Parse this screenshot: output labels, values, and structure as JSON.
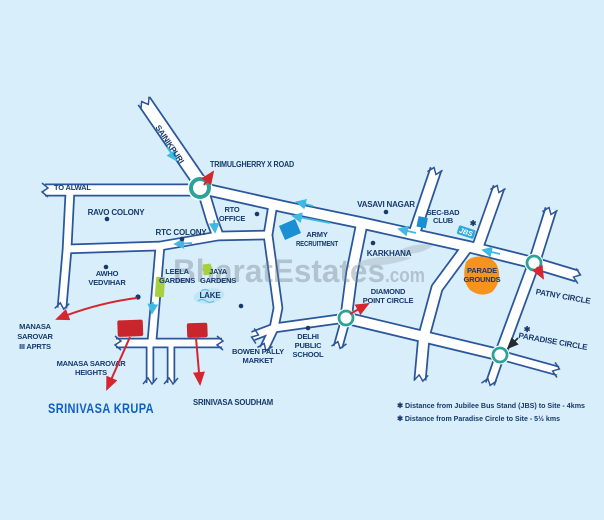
{
  "watermark": {
    "name": "BharatEstates",
    "tld": ".com"
  },
  "site": {
    "name": "SRINIVASA KRUPA",
    "sister": "SRINIVASA SOUDHAM"
  },
  "roads": {
    "sainikpuri": "SAINIKPURI",
    "to_alwal": "TO ALWAL",
    "trimulgherry": "TRIMULGHERRY X ROAD"
  },
  "places": {
    "ravo_colony": "RAVO COLONY",
    "rtc_colony": "RTC COLONY",
    "rto_office": [
      "RTO",
      "OFFICE"
    ],
    "army_recruitment": [
      "ARMY",
      "RECRUITMENT"
    ],
    "vasavi_nagar": "VASAVI NAGAR",
    "sec_bad_club": [
      "SEC-BAD",
      "CLUB"
    ],
    "jbs": "JBS",
    "karkhana": "KARKHANA",
    "parade_grounds": [
      "PARADE",
      "GROUNDS"
    ],
    "patny_circle": "PATNY CIRCLE",
    "paradise_circle": "PARADISE CIRCLE",
    "diamond_point_circle": [
      "DIAMOND",
      "POINT CIRCLE"
    ],
    "awho_vedvihar": [
      "AWHO",
      "VEDVIHAR"
    ],
    "leela_gardens": [
      "LEELA",
      "GARDENS"
    ],
    "jaya_gardens": [
      "JAYA",
      "GARDENS"
    ],
    "lake": "LAKE",
    "manasa_sarovar_apts": [
      "MANASA",
      "SAROVAR",
      "III APRTS"
    ],
    "manasa_sarovar_heights": [
      "MANASA SAROVAR",
      "HEIGHTS"
    ],
    "bowen_pally_market": [
      "BOWEN PALLY",
      "MARKET"
    ],
    "delhi_public_school": [
      "DELHI",
      "PUBLIC",
      "SCHOOL"
    ]
  },
  "symbols": {
    "distance_marker": "✱"
  },
  "legend": {
    "line1": "✱ Distance from Jubilee Bus Stand (JBS) to Site - 4kms",
    "line2": "✱ Distance from Paradise Circle to Site - 5½  kms"
  },
  "colors": {
    "background": "#d9eefb",
    "road_casing": "#2a569c",
    "label_text": "#173a6d",
    "site_name_text": "#1060c4",
    "site_marker_red": "#c9252c",
    "pointer_red": "#d4262f",
    "junction_circle_teal": "#2ba39a",
    "direction_arrow_cyan": "#3fb9e3",
    "parade_grounds_orange": "#f6921e",
    "garden_green": "#a8cf3d",
    "club_marker_blue": "#1b8fd4",
    "jbs_badge_cyan": "#2fa9de",
    "lake_blue": "#c2e5f5"
  }
}
